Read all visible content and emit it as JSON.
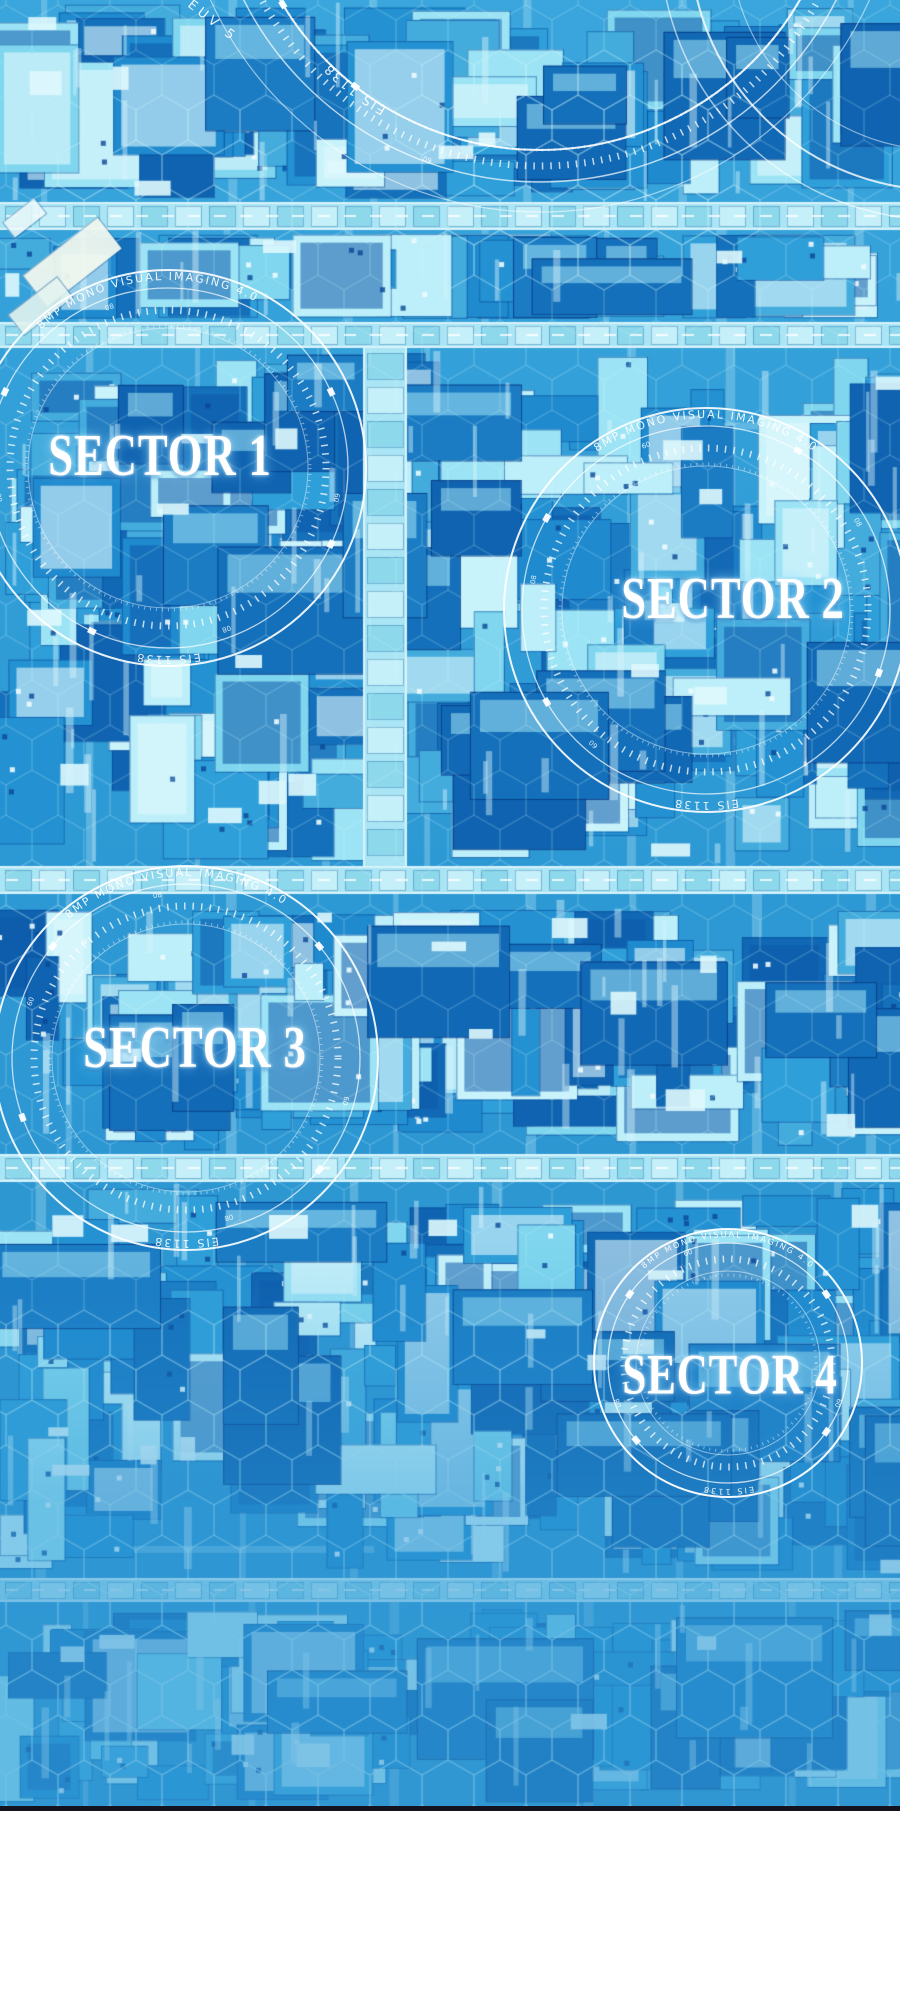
{
  "map": {
    "type": "tactical-city-blueprint",
    "sectors": [
      {
        "id": 1,
        "label": "SECTOR 1"
      },
      {
        "id": 2,
        "label": "SECTOR 2"
      },
      {
        "id": 3,
        "label": "SECTOR 3"
      },
      {
        "id": 4,
        "label": "SECTOR 4"
      }
    ],
    "hud": {
      "arc_text_top": "8MP MONO VISUAL IMAGING 4.0",
      "arc_text_bottom": "EIS 1138",
      "arc_text_outer": "EUV 5",
      "tick_digits": [
        "60",
        "08"
      ]
    },
    "colors": {
      "base": "#2d99d4",
      "base_top": "#3aa6dd",
      "building_dark": "#1470ba",
      "building_mid": "#2f9fd9",
      "building_light": "#8fdef2",
      "building_pale": "#c9f3fb",
      "road": "#a9e5f4",
      "road_module": "#c6f0f9",
      "hex": "#cdf4fc",
      "ring": "#ffffff",
      "fade": "#2f96d4",
      "divider": "#12131d",
      "footer": "#ffffff"
    }
  }
}
